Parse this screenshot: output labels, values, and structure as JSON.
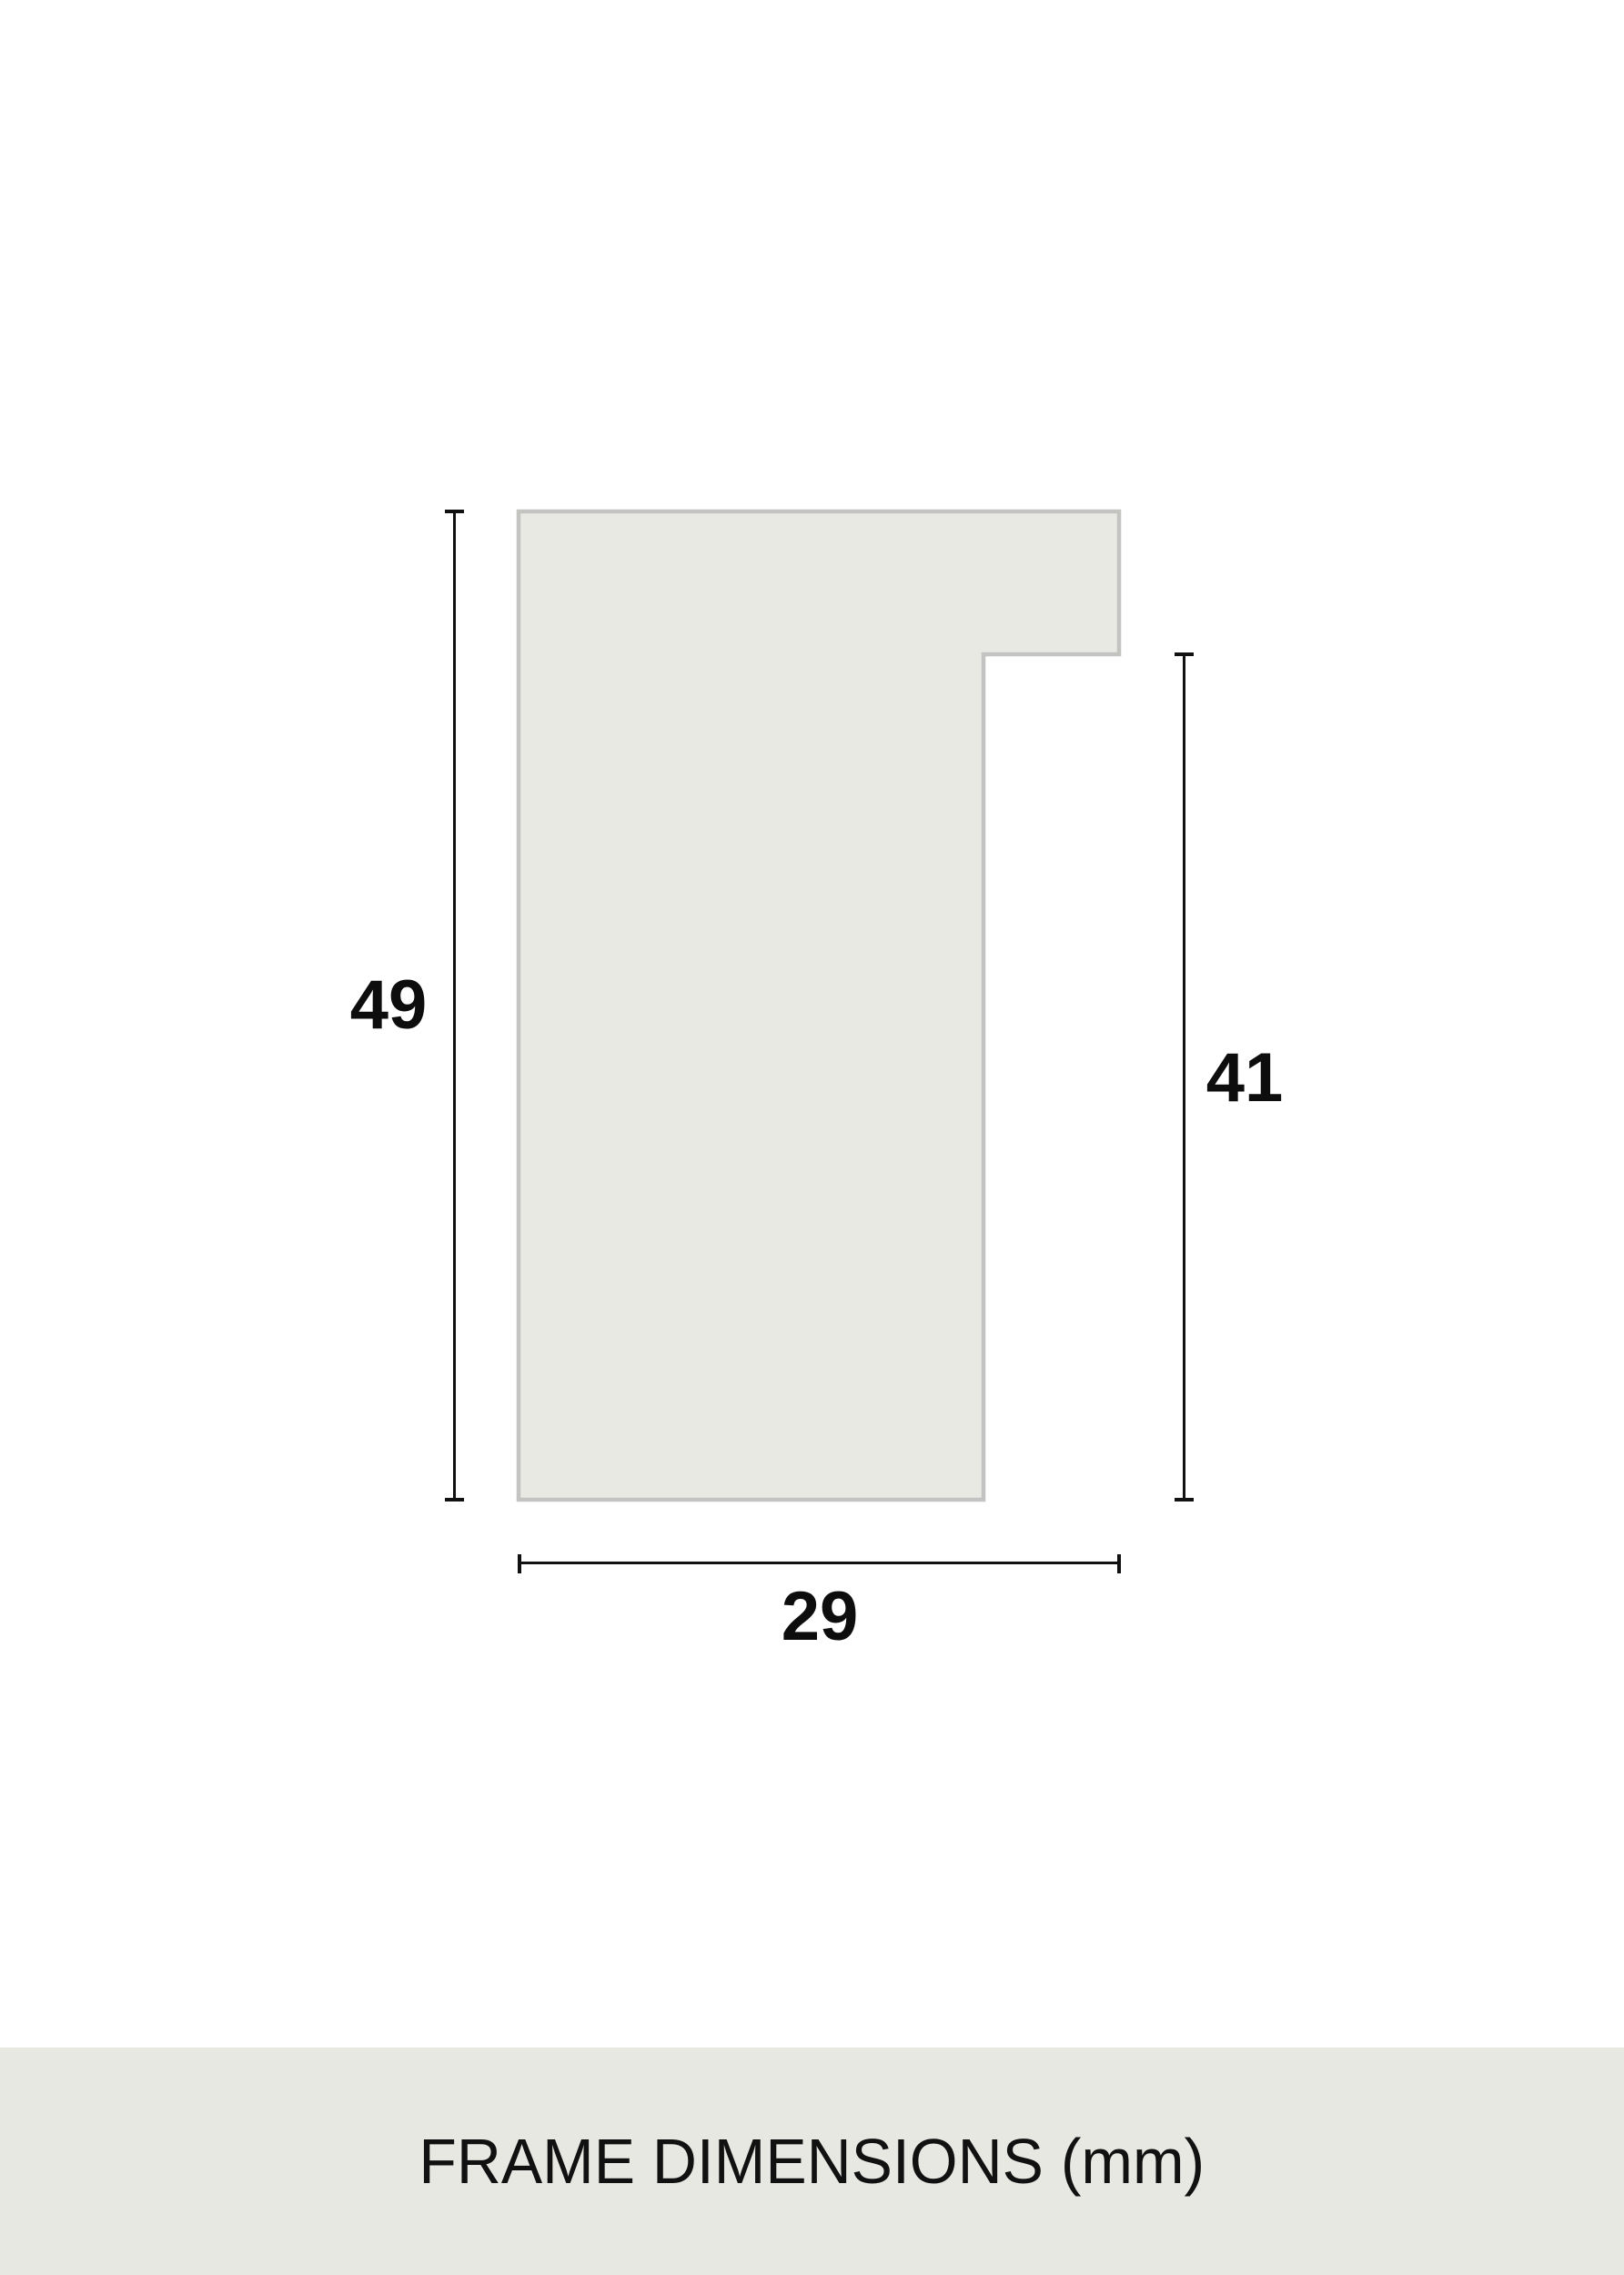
{
  "diagram": {
    "type": "frame-profile-cross-section",
    "unit": "mm",
    "measurements": {
      "outer_height": "49",
      "inner_height": "41",
      "width": "29"
    },
    "colors": {
      "background": "#ffffff",
      "profile_fill": "#e9e9e4",
      "profile_border": "#c3c3c1",
      "dimension_line": "#111111",
      "label_text": "#0d0d0d",
      "footer_background": "#e8e8e3"
    }
  },
  "footer": {
    "caption": "FRAME DIMENSIONS (mm)"
  }
}
